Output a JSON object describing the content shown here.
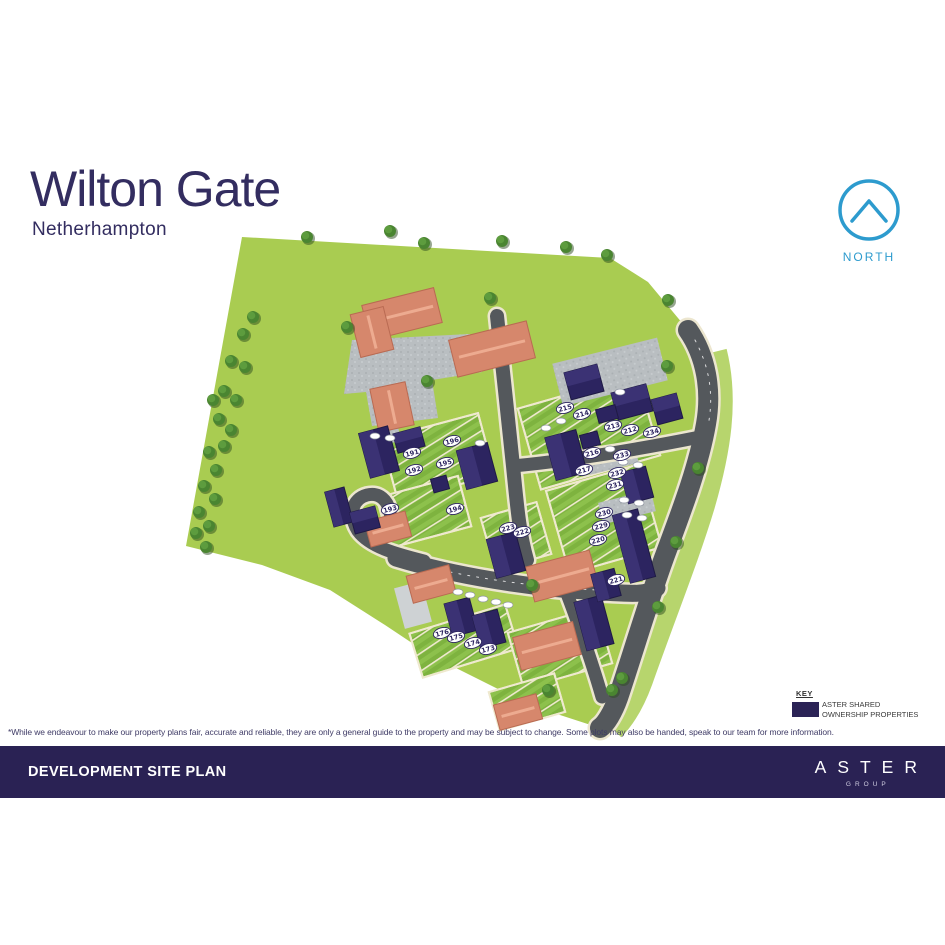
{
  "header": {
    "title": "Wilton Gate",
    "subtitle": "Netherhampton"
  },
  "compass": {
    "label": "NORTH"
  },
  "key": {
    "title": "KEY",
    "item_line1": "ASTER SHARED",
    "item_line2": "OWNERSHIP PROPERTIES",
    "swatch_color": "#2b2356"
  },
  "disclaimer": "*While we endeavour to make our property plans fair, accurate and reliable, they are only a general guide to the property and may be subject to change. Some plots may also be handed, speak to our team for more information.",
  "footer": {
    "title": "DEVELOPMENT SITE PLAN",
    "brand": "ASTER",
    "brand_sub": "GROUP"
  },
  "colors": {
    "navy": "#2a2254",
    "accent_blue": "#2d9bce",
    "field_green": "#a9cc51",
    "garden_green": "#7eb33f",
    "road_grey": "#54585c",
    "parking_grey": "#b9bec1",
    "roof_salmon": "#d6876c",
    "shared_ownership_navy": "#2c2460",
    "fence_cream": "#efe9cf"
  },
  "site_plan": {
    "legend_note": "numbered ovals are plot numbers",
    "plots": [
      {
        "label": "196",
        "x": 452,
        "y": 441
      },
      {
        "label": "195",
        "x": 445,
        "y": 463
      },
      {
        "label": "191",
        "x": 412,
        "y": 453
      },
      {
        "label": "192",
        "x": 414,
        "y": 470
      },
      {
        "label": "193",
        "x": 390,
        "y": 509
      },
      {
        "label": "194",
        "x": 455,
        "y": 509
      },
      {
        "label": "176",
        "x": 442,
        "y": 633
      },
      {
        "label": "175",
        "x": 456,
        "y": 637
      },
      {
        "label": "174",
        "x": 473,
        "y": 643
      },
      {
        "label": "173",
        "x": 488,
        "y": 649
      },
      {
        "label": "215",
        "x": 565,
        "y": 408
      },
      {
        "label": "214",
        "x": 582,
        "y": 414
      },
      {
        "label": "213",
        "x": 613,
        "y": 426
      },
      {
        "label": "212",
        "x": 630,
        "y": 430
      },
      {
        "label": "234",
        "x": 652,
        "y": 432
      },
      {
        "label": "216",
        "x": 592,
        "y": 453
      },
      {
        "label": "233",
        "x": 622,
        "y": 455
      },
      {
        "label": "217",
        "x": 584,
        "y": 470
      },
      {
        "label": "232",
        "x": 617,
        "y": 473
      },
      {
        "label": "231",
        "x": 615,
        "y": 485
      },
      {
        "label": "230",
        "x": 604,
        "y": 513
      },
      {
        "label": "229",
        "x": 601,
        "y": 526
      },
      {
        "label": "220",
        "x": 598,
        "y": 540
      },
      {
        "label": "221",
        "x": 616,
        "y": 580
      },
      {
        "label": "223",
        "x": 508,
        "y": 528
      },
      {
        "label": "222",
        "x": 522,
        "y": 532
      }
    ]
  }
}
